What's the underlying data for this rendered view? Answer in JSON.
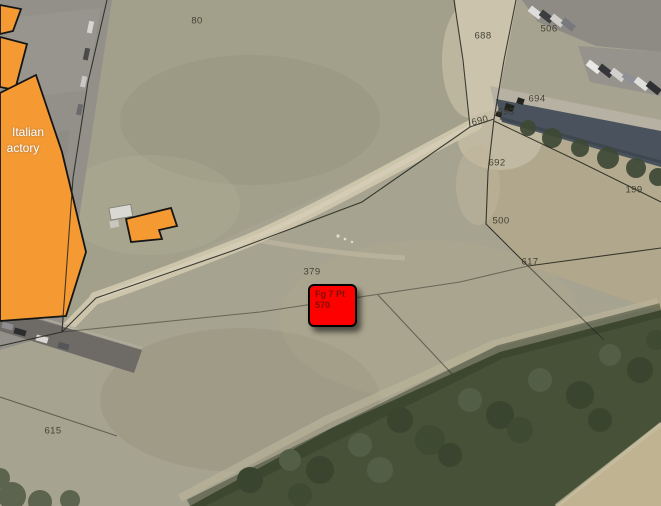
{
  "map": {
    "description": "Aerial cadastral map with highlighted parcel marker",
    "parcel_labels": [
      {
        "text": "80",
        "x": 197,
        "y": 21
      },
      {
        "text": "688",
        "x": 483,
        "y": 36
      },
      {
        "text": "506",
        "x": 549,
        "y": 29
      },
      {
        "text": "694",
        "x": 537,
        "y": 99
      },
      {
        "text": "693",
        "x": 506,
        "y": 112
      },
      {
        "text": "690",
        "x": 480,
        "y": 121
      },
      {
        "text": "692",
        "x": 497,
        "y": 163
      },
      {
        "text": "500",
        "x": 501,
        "y": 221
      },
      {
        "text": "617",
        "x": 530,
        "y": 262
      },
      {
        "text": "199",
        "x": 634,
        "y": 190
      },
      {
        "text": "379",
        "x": 312,
        "y": 272
      },
      {
        "text": "615",
        "x": 53,
        "y": 431
      }
    ],
    "marker": {
      "line1": "Fg 7 Pt",
      "line2": "570",
      "x": 308,
      "y": 284,
      "w": 49,
      "h": 43
    },
    "building_label": {
      "line1": "Italian",
      "line2": "actory",
      "pos1": {
        "x": 28,
        "y": 132
      },
      "pos2": {
        "x": 23,
        "y": 148
      }
    },
    "colors": {
      "highlight_orange": "#f59a33",
      "grass": "#a6a390",
      "dirt_track": "#ccc4ab",
      "asphalt": "#93908a",
      "road": "#6e6b67",
      "trees": "#465138",
      "water": "#4a535d",
      "cadastral_line": "#23231c",
      "marker_red": "#fe0000",
      "marker_text": "#7c1203",
      "building_label_color": "#ffffff"
    }
  }
}
